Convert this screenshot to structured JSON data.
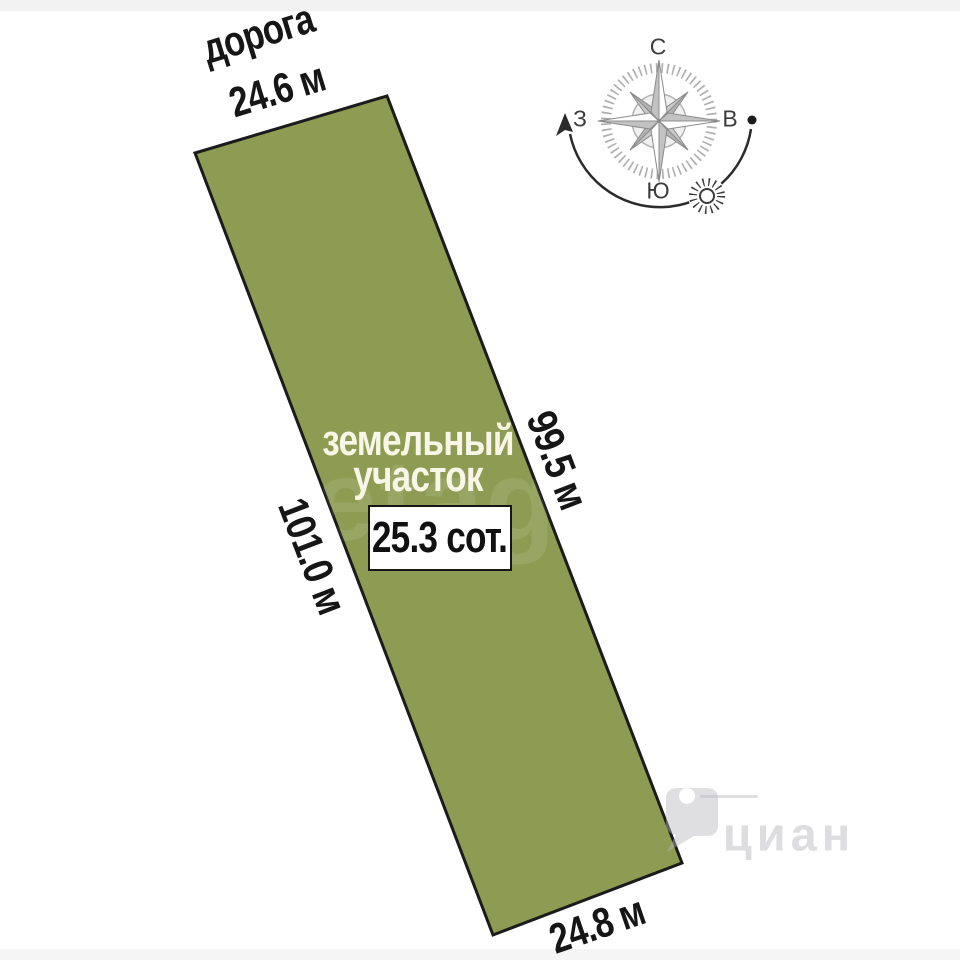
{
  "plot": {
    "name_line1": "земельный",
    "name_line2": "участок",
    "area": "25.3 сот."
  },
  "labels": {
    "road": "дорога"
  },
  "dimensions": {
    "top": "24.6 м",
    "bottom": "24.8 м",
    "left": "101.0 м",
    "right": "99.5 м"
  },
  "compass": {
    "north": "С",
    "south": "Ю",
    "west": "З",
    "east": "В"
  },
  "watermarks": {
    "center": "etagi",
    "corner": "циан"
  },
  "colors": {
    "plot_fill": "#8e9b52",
    "plot_border": "#1b1b1b",
    "dimension_text": "#161616",
    "plot_text": "#f8f6e7",
    "compass_gray": "#9a9a9a"
  }
}
